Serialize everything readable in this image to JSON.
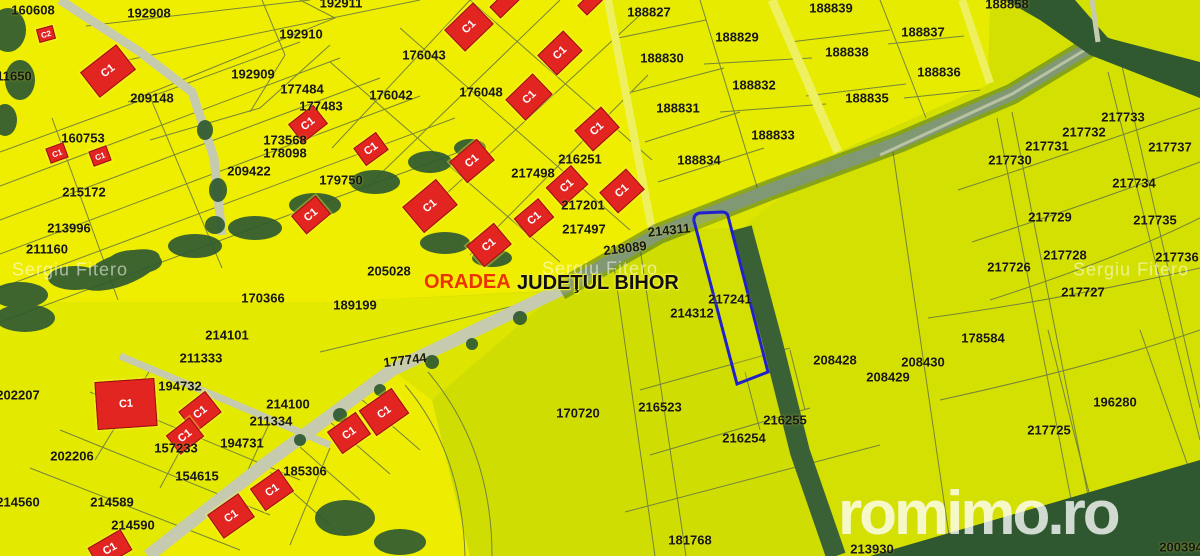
{
  "map": {
    "city_label": "ORADEA",
    "county_label": "JUDEŢUL BIHOR",
    "highlighted_parcel": "217241",
    "watermark_text": "Sergiu Fitero",
    "brand_text": "romimo.ro",
    "colors": {
      "parcel_bright": "#f0ee00",
      "parcel_green": "#d4e002",
      "boundary_line": "#6a7a40",
      "road": "#c6cbb0",
      "forest": "#2f5a31",
      "building_red": "#e32522",
      "highlight_blue": "#2020cc",
      "label_text": "#171717",
      "city_red": "#e83400"
    },
    "watermarks": [
      {
        "x": 70,
        "y": 270
      },
      {
        "x": 600,
        "y": 269
      },
      {
        "x": 1131,
        "y": 270
      }
    ],
    "parcel_labels": [
      {
        "t": "160608",
        "x": 33,
        "y": 10
      },
      {
        "t": "192908",
        "x": 149,
        "y": 13
      },
      {
        "t": "192911",
        "x": 341,
        "y": 3
      },
      {
        "t": "192910",
        "x": 301,
        "y": 34
      },
      {
        "t": "192909",
        "x": 253,
        "y": 74
      },
      {
        "t": "209148",
        "x": 152,
        "y": 98
      },
      {
        "t": "177484",
        "x": 302,
        "y": 89
      },
      {
        "t": "177483",
        "x": 321,
        "y": 106
      },
      {
        "t": "176043",
        "x": 424,
        "y": 55
      },
      {
        "t": "176042",
        "x": 391,
        "y": 95
      },
      {
        "t": "176048",
        "x": 481,
        "y": 92
      },
      {
        "t": "173568",
        "x": 285,
        "y": 140
      },
      {
        "t": "178098",
        "x": 285,
        "y": 153
      },
      {
        "t": "209422",
        "x": 249,
        "y": 171
      },
      {
        "t": "160753",
        "x": 83,
        "y": 138
      },
      {
        "t": "215172",
        "x": 84,
        "y": 192
      },
      {
        "t": "179750",
        "x": 341,
        "y": 180
      },
      {
        "t": "213996",
        "x": 69,
        "y": 228
      },
      {
        "t": "211160",
        "x": 47,
        "y": 249
      },
      {
        "t": "11650",
        "x": 14,
        "y": 76
      },
      {
        "t": "205028",
        "x": 389,
        "y": 271
      },
      {
        "t": "170366",
        "x": 263,
        "y": 298
      },
      {
        "t": "189199",
        "x": 355,
        "y": 305
      },
      {
        "t": "214101",
        "x": 227,
        "y": 335
      },
      {
        "t": "211333",
        "x": 201,
        "y": 358
      },
      {
        "t": "194732",
        "x": 180,
        "y": 386
      },
      {
        "t": "202207",
        "x": 18,
        "y": 395
      },
      {
        "t": "177744",
        "x": 405,
        "y": 360,
        "r": -7
      },
      {
        "t": "214100",
        "x": 288,
        "y": 404
      },
      {
        "t": "211334",
        "x": 271,
        "y": 421
      },
      {
        "t": "194731",
        "x": 242,
        "y": 443
      },
      {
        "t": "157233",
        "x": 176,
        "y": 448
      },
      {
        "t": "154615",
        "x": 197,
        "y": 476
      },
      {
        "t": "202206",
        "x": 72,
        "y": 456
      },
      {
        "t": "214560",
        "x": 18,
        "y": 502
      },
      {
        "t": "214589",
        "x": 112,
        "y": 502
      },
      {
        "t": "214590",
        "x": 133,
        "y": 525
      },
      {
        "t": "185306",
        "x": 305,
        "y": 471
      },
      {
        "t": "188827",
        "x": 649,
        "y": 12
      },
      {
        "t": "188829",
        "x": 737,
        "y": 37
      },
      {
        "t": "188839",
        "x": 831,
        "y": 8
      },
      {
        "t": "188830",
        "x": 662,
        "y": 58
      },
      {
        "t": "188838",
        "x": 847,
        "y": 52
      },
      {
        "t": "188832",
        "x": 754,
        "y": 85
      },
      {
        "t": "188835",
        "x": 867,
        "y": 98
      },
      {
        "t": "188831",
        "x": 678,
        "y": 108
      },
      {
        "t": "188833",
        "x": 773,
        "y": 135
      },
      {
        "t": "188834",
        "x": 699,
        "y": 160
      },
      {
        "t": "188837",
        "x": 923,
        "y": 32
      },
      {
        "t": "188836",
        "x": 939,
        "y": 72
      },
      {
        "t": "188858",
        "x": 1007,
        "y": 4
      },
      {
        "t": "216251",
        "x": 580,
        "y": 159
      },
      {
        "t": "217498",
        "x": 533,
        "y": 173
      },
      {
        "t": "217201",
        "x": 583,
        "y": 205
      },
      {
        "t": "217497",
        "x": 584,
        "y": 229
      },
      {
        "t": "218089",
        "x": 625,
        "y": 248,
        "r": -7
      },
      {
        "t": "214311",
        "x": 669,
        "y": 230,
        "r": -6
      },
      {
        "t": "217241",
        "x": 730,
        "y": 299
      },
      {
        "t": "214312",
        "x": 692,
        "y": 313
      },
      {
        "t": "216523",
        "x": 660,
        "y": 407
      },
      {
        "t": "216255",
        "x": 785,
        "y": 420
      },
      {
        "t": "216254",
        "x": 744,
        "y": 438
      },
      {
        "t": "170720",
        "x": 578,
        "y": 413
      },
      {
        "t": "181768",
        "x": 690,
        "y": 540
      },
      {
        "t": "213930",
        "x": 872,
        "y": 549
      },
      {
        "t": "217732",
        "x": 1084,
        "y": 132
      },
      {
        "t": "217731",
        "x": 1047,
        "y": 146
      },
      {
        "t": "217737",
        "x": 1170,
        "y": 147
      },
      {
        "t": "217730",
        "x": 1010,
        "y": 160
      },
      {
        "t": "217733",
        "x": 1123,
        "y": 117
      },
      {
        "t": "217734",
        "x": 1134,
        "y": 183
      },
      {
        "t": "217729",
        "x": 1050,
        "y": 217
      },
      {
        "t": "217735",
        "x": 1155,
        "y": 220
      },
      {
        "t": "217728",
        "x": 1065,
        "y": 255
      },
      {
        "t": "217736",
        "x": 1177,
        "y": 257
      },
      {
        "t": "217726",
        "x": 1009,
        "y": 267
      },
      {
        "t": "217727",
        "x": 1083,
        "y": 292
      },
      {
        "t": "178584",
        "x": 983,
        "y": 338
      },
      {
        "t": "208428",
        "x": 835,
        "y": 360
      },
      {
        "t": "208430",
        "x": 923,
        "y": 362
      },
      {
        "t": "208429",
        "x": 888,
        "y": 377
      },
      {
        "t": "196280",
        "x": 1115,
        "y": 402
      },
      {
        "t": "217725",
        "x": 1049,
        "y": 430
      },
      {
        "t": "200394",
        "x": 1181,
        "y": 547
      }
    ],
    "buildings": [
      {
        "t": "C1",
        "x": 108,
        "y": 71,
        "w": 44,
        "h": 30,
        "r": -38
      },
      {
        "t": "C1",
        "x": 308,
        "y": 124,
        "w": 30,
        "h": 22,
        "r": -38
      },
      {
        "t": "C1",
        "x": 371,
        "y": 149,
        "w": 26,
        "h": 20,
        "r": -36
      },
      {
        "t": "C1",
        "x": 311,
        "y": 215,
        "w": 30,
        "h": 22,
        "r": -40
      },
      {
        "t": "C1",
        "x": 430,
        "y": 206,
        "w": 42,
        "h": 32,
        "r": -40
      },
      {
        "t": "C1",
        "x": 469,
        "y": 27,
        "w": 38,
        "h": 28,
        "r": -44
      },
      {
        "t": "C1",
        "x": 560,
        "y": 53,
        "w": 34,
        "h": 26,
        "r": -44
      },
      {
        "t": "C1",
        "x": 529,
        "y": 97,
        "w": 36,
        "h": 27,
        "r": -44
      },
      {
        "t": "C1",
        "x": 472,
        "y": 161,
        "w": 34,
        "h": 26,
        "r": -40
      },
      {
        "t": "C1",
        "x": 489,
        "y": 245,
        "w": 34,
        "h": 26,
        "r": -40
      },
      {
        "t": "C1",
        "x": 534,
        "y": 218,
        "w": 30,
        "h": 23,
        "r": -40
      },
      {
        "t": "C1",
        "x": 597,
        "y": 129,
        "w": 34,
        "h": 26,
        "r": -42
      },
      {
        "t": "C1",
        "x": 567,
        "y": 186,
        "w": 32,
        "h": 24,
        "r": -42
      },
      {
        "t": "C1",
        "x": 622,
        "y": 191,
        "w": 34,
        "h": 26,
        "r": -42
      },
      {
        "t": "C1",
        "x": 126,
        "y": 404,
        "w": 58,
        "h": 46,
        "r": -4
      },
      {
        "t": "C1",
        "x": 200,
        "y": 412,
        "w": 32,
        "h": 25,
        "r": -38
      },
      {
        "t": "C1",
        "x": 185,
        "y": 436,
        "w": 28,
        "h": 22,
        "r": -38
      },
      {
        "t": "C1",
        "x": 231,
        "y": 516,
        "w": 36,
        "h": 27,
        "r": -35
      },
      {
        "t": "C1",
        "x": 272,
        "y": 490,
        "w": 33,
        "h": 25,
        "r": -35
      },
      {
        "t": "C1",
        "x": 384,
        "y": 412,
        "w": 38,
        "h": 29,
        "r": -35
      },
      {
        "t": "C1",
        "x": 349,
        "y": 433,
        "w": 33,
        "h": 25,
        "r": -35
      },
      {
        "t": "C1",
        "x": 110,
        "y": 549,
        "w": 36,
        "h": 22,
        "r": -30
      },
      {
        "t": "C1",
        "x": 57,
        "y": 153,
        "w": 17,
        "h": 14,
        "r": -20,
        "small": true
      },
      {
        "t": "C1",
        "x": 100,
        "y": 156,
        "w": 17,
        "h": 14,
        "r": -20,
        "small": true
      },
      {
        "t": "C2",
        "x": 46,
        "y": 34,
        "w": 15,
        "h": 12,
        "r": -15,
        "small": true
      },
      {
        "t": "",
        "x": 505,
        "y": 3,
        "w": 26,
        "h": 14,
        "r": -44
      },
      {
        "t": "",
        "x": 590,
        "y": 3,
        "w": 20,
        "h": 12,
        "r": -44
      }
    ]
  }
}
